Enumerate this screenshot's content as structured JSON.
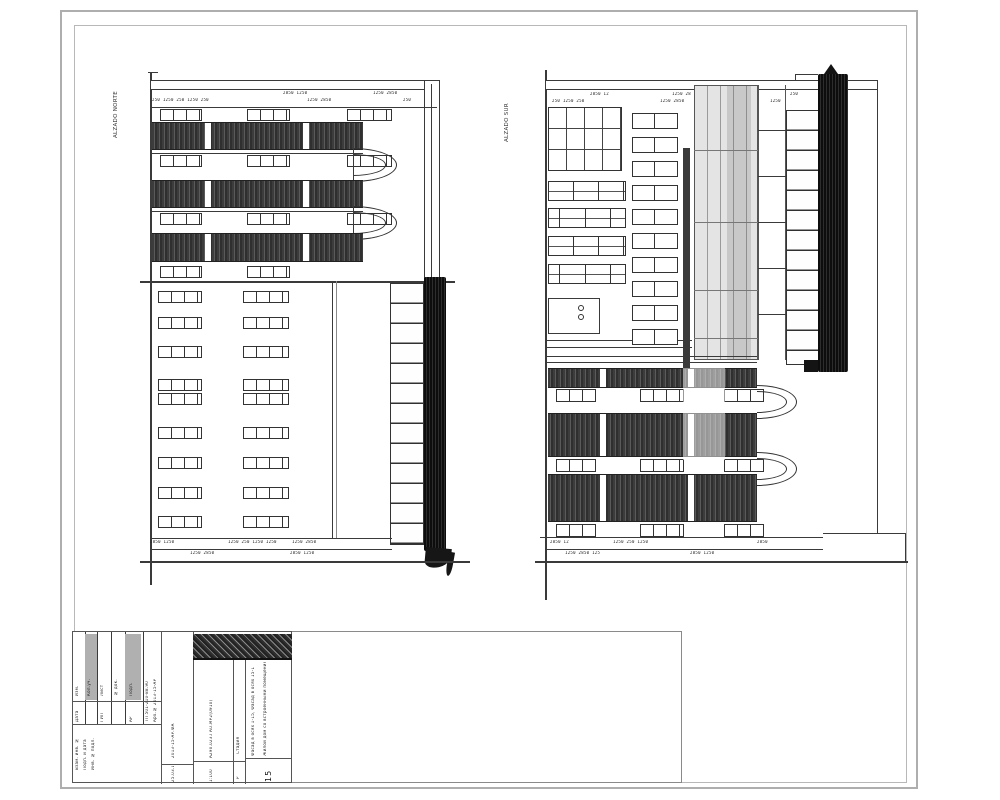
{
  "labels": {
    "left_elevation": "ALZADO NORTE",
    "right_elevation": "ALZADO SUR"
  },
  "dims": {
    "left": {
      "top_row1": [
        "2850 1250",
        "1250 2850"
      ],
      "top_row2": [
        "250 1250 250 1250 250",
        "1250 2850",
        "250"
      ],
      "base_row1": [
        "2850 1250",
        "1250 250 1250 1250",
        "1250 2850"
      ],
      "base_row2": [
        "1250 2850",
        "2850 1250"
      ]
    },
    "right": {
      "top_row1": [
        "2850 12",
        "1250 28",
        "250"
      ],
      "top_row2": [
        "250 1250 250",
        "1250 2850",
        "1250"
      ],
      "base_row1": [
        "2850 12",
        "1250 250 1250",
        "2850"
      ],
      "base_row2": [
        "1250 2850 125",
        "2850 1250"
      ]
    }
  },
  "title_block": {
    "rev_labels": [
      "Изм.",
      "Кол.уч.",
      "Лист",
      "№ док.",
      "Подп."
    ],
    "sub_row": [
      "Дата",
      "ГИП",
      "АР"
    ],
    "approve_lines": [
      "Взам. инв. №",
      "Подп. и дата",
      "Инв. № подл."
    ],
    "doc_col_line1": "ТП 501-210-88.90",
    "doc_col_line2": "Арх.№ 2013-15-АР",
    "mid_col_text": "2013-15-АР.ФА",
    "mid_col_bottom": "25.03.13",
    "stamp_code": "А290.023.ГАО.МР2(0910)",
    "stage_col_text": "Стадия",
    "stage_col_bottom": "Р",
    "name_line1": "Фасад в осях 1-15, Фасад в осях 15-1",
    "name_line2": "Жилой дом со встроенными помещениями",
    "scale": "1:100",
    "sheet_number": "15"
  }
}
